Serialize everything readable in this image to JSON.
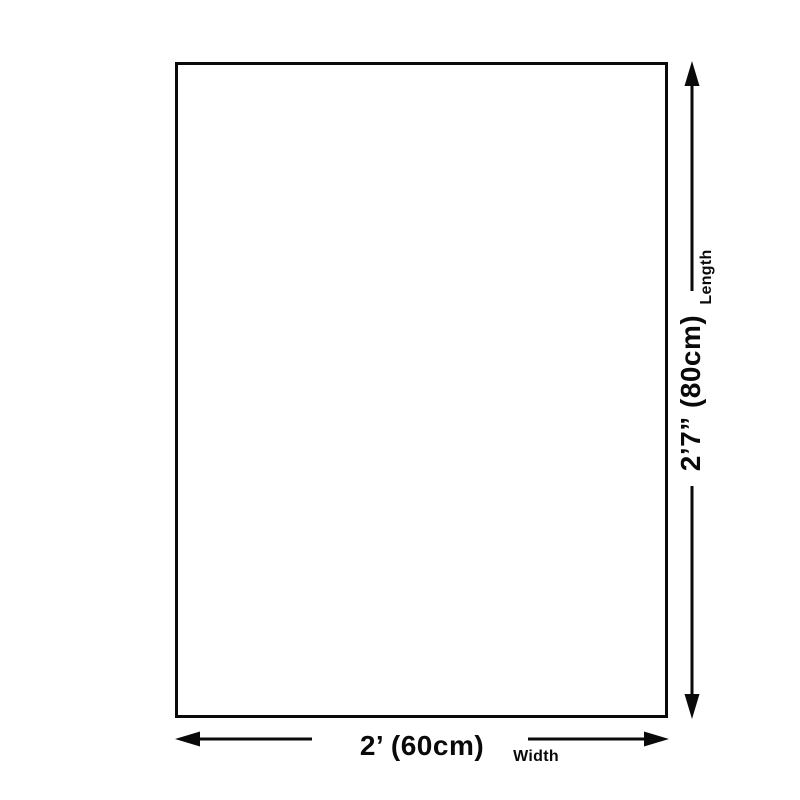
{
  "colors": {
    "ink": "#0a0a0a",
    "paper": "#ffffff"
  },
  "diagram": {
    "width_dimension": {
      "value": "2’ (60cm)",
      "label": "Width"
    },
    "length_dimension": {
      "value": "2’7” (80cm)",
      "label": "Length"
    }
  }
}
